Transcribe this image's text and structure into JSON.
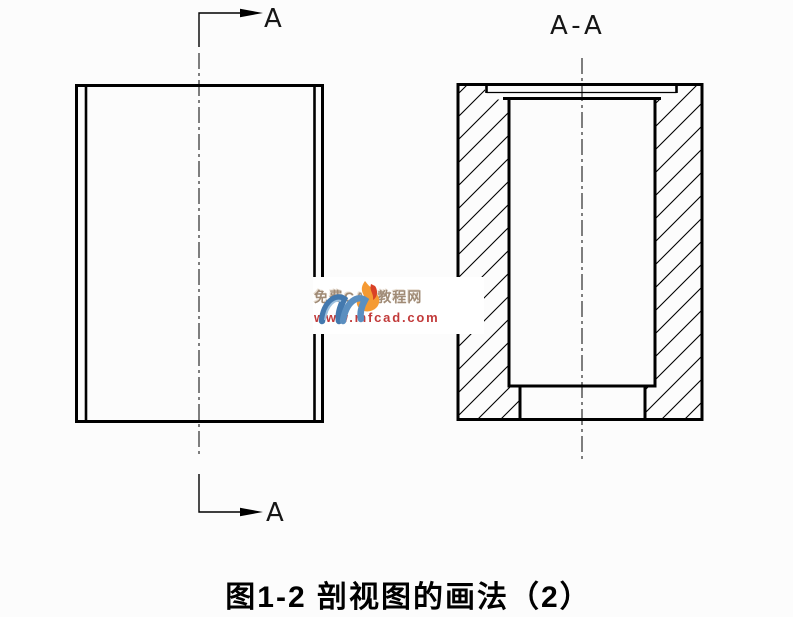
{
  "figure": {
    "caption": "图1-2 剖视图的画法（2）",
    "front_view": {
      "cut_label_top": "A",
      "cut_label_bottom": "A"
    },
    "section_view": {
      "label": "A-A"
    }
  },
  "watermark": {
    "site_name": "免费CAD教程网",
    "site_url": "www.mfcad.com"
  },
  "colors": {
    "line": "#000000",
    "logo_blue": "#4479ae",
    "logo_blue_light": "#7fa9d2",
    "logo_orange": "#f59a33",
    "logo_red": "#d94126",
    "watermark_text": "#a08b76",
    "watermark_url": "#c23b3b"
  }
}
